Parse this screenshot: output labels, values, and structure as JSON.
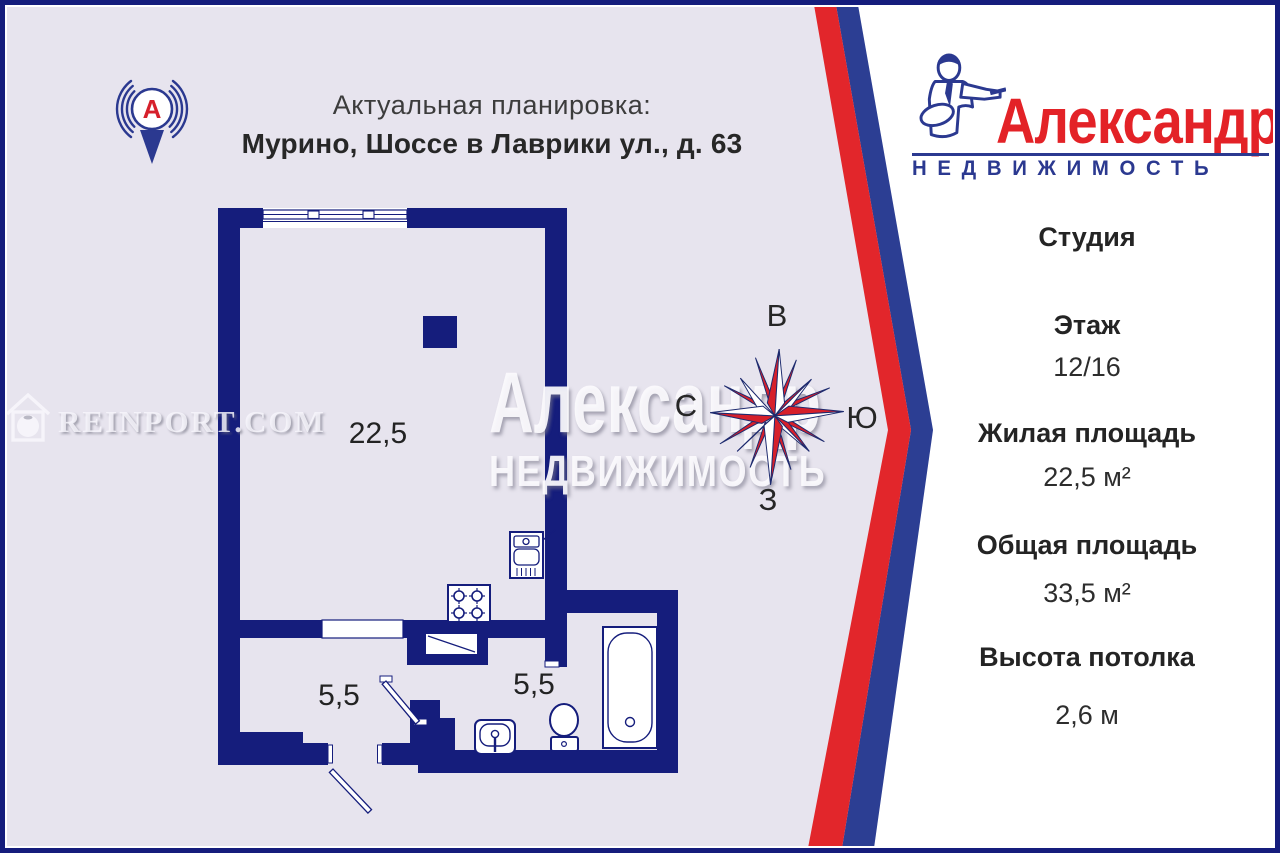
{
  "header": {
    "line1": "Актуальная планировка:",
    "line2": "Мурино, Шоссе в Лаврики ул., д. 63"
  },
  "pin": {
    "letter": "А"
  },
  "brand": {
    "name": "Александр",
    "tagline": "НЕДВИЖИМОСТЬ"
  },
  "panel": {
    "title": "Студия",
    "rows": [
      {
        "label": "Этаж",
        "value": "12/16"
      },
      {
        "label": "Жилая площадь",
        "value": "22,5 м²"
      },
      {
        "label": "Общая площадь",
        "value": "33,5 м²"
      },
      {
        "label": "Высота потолка",
        "value": "2,6 м"
      }
    ]
  },
  "plan": {
    "main_room_area": "22,5",
    "hall_area": "5,5",
    "bath_area": "5,5"
  },
  "compass": {
    "top": "В",
    "left": "С",
    "right": "Ю",
    "bottom": "З"
  },
  "watermarks": {
    "site": "REINPORT.COM",
    "big": "Александр",
    "sub": "НЕДВИЖИМОСТЬ"
  },
  "colors": {
    "walls_navy": "#151d7c",
    "stripe_blue": "#2c3e93",
    "stripe_red": "#e2262b",
    "background_lavender": "#e7e4ee",
    "brand_red": "#e32227",
    "brand_blue": "#2b3990"
  }
}
